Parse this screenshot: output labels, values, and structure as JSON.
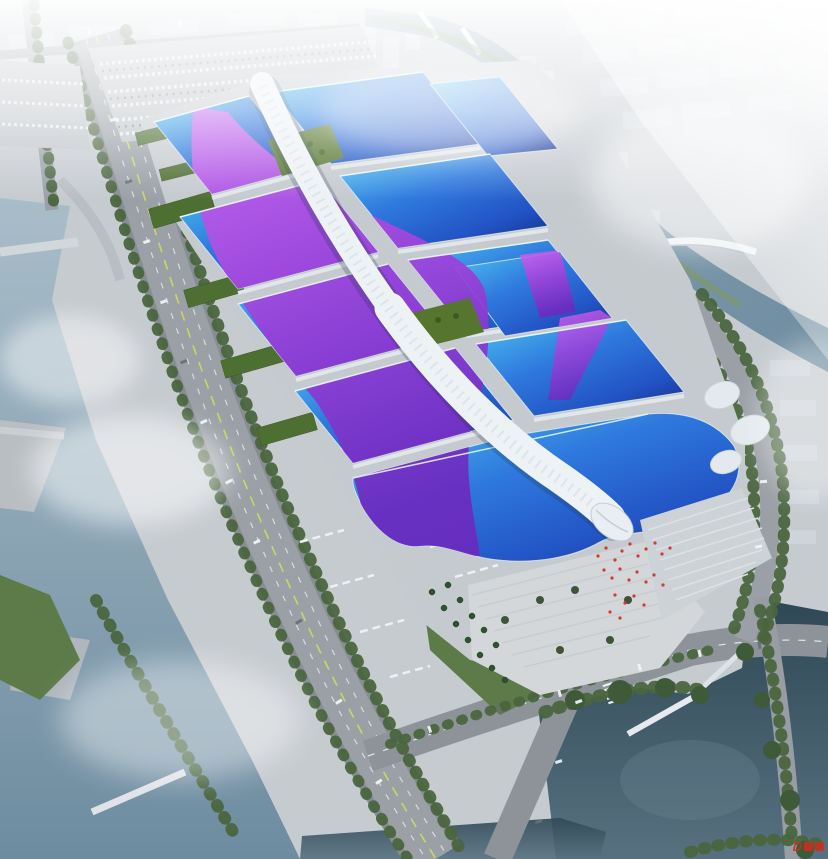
{
  "scene": {
    "title": "aerial-rendering-exhibition-center",
    "description": "Aerial architectural rendering of a vast exhibition and convention center: rows of blue wave-form hall roofs crossed by a sweeping magenta-violet ribbon, linked by a white serpentine central corridor ending in a shell-shaped entrance hall, surrounded by service yards, tree-lined highways, rivers, ponds and a hazy white city skyline.",
    "watermark": {
      "text": "D"
    }
  },
  "colors": {
    "ground": "#c6cbd0",
    "platform": "#c5cacf",
    "road": "#8f959b",
    "roof_cyan": "#4ec3ef",
    "roof_blue": "#2f7ade",
    "roof_mid": "#2253c4",
    "roof_navy": "#16328f",
    "ribbon_magenta": "#cf63f0",
    "ribbon_purple": "#9a3fd8",
    "ribbon_violet": "#6c2abf",
    "spine_white": "#edf2f5",
    "water_light": "#a9bdc9",
    "water_mid": "#6e8ca0",
    "water_dark": "#33505f",
    "pond_dark": "#2f4856",
    "tree_green": "#4a653e",
    "lawn_green": "#86a05e",
    "roof_green": "#4d7032",
    "flag_red": "#d23c30",
    "fog_white": "#ffffff",
    "watermark_red": "#d42b1e"
  }
}
